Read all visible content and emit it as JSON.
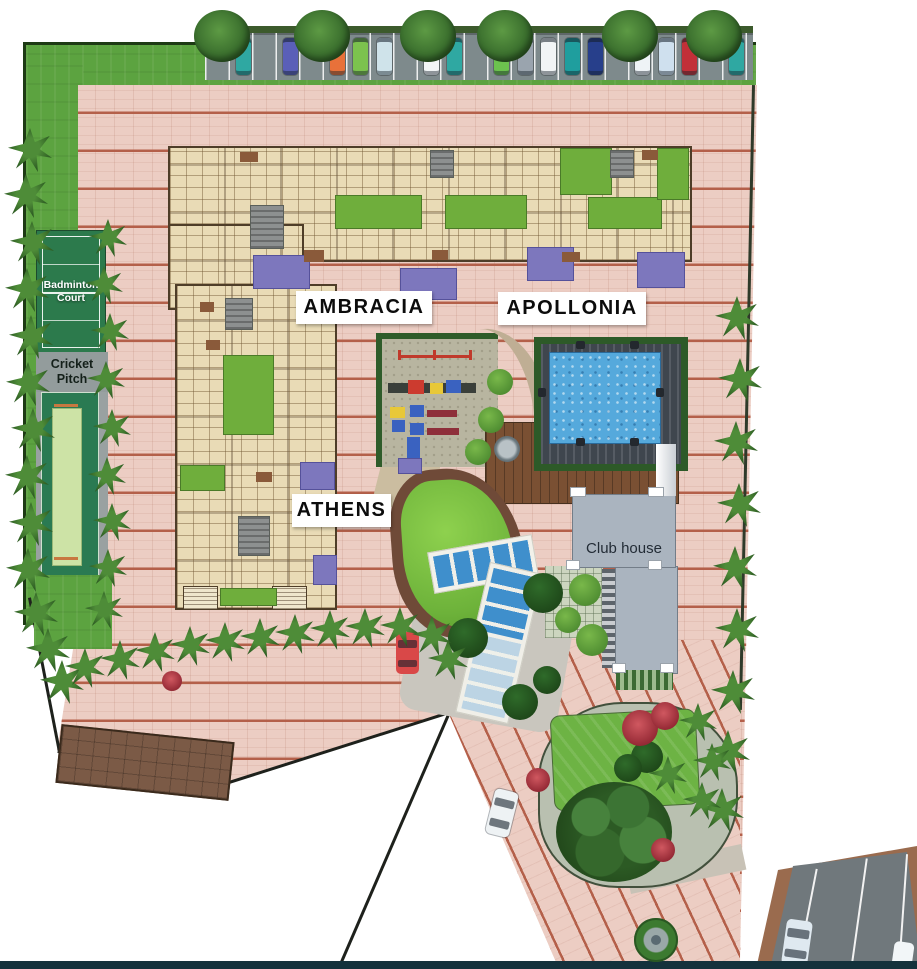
{
  "labels": {
    "ambracia": "AMBRACIA",
    "apollonia": "APOLLONIA",
    "athens": "ATHENS",
    "club_house": "Club house",
    "badminton_court": "Badminton Court",
    "cricket_pitch": "Cricket Pitch"
  },
  "colors": {
    "paving": "#eccdc3",
    "paving_stripe": "#b4604a",
    "lawn": "#5ca340",
    "court_green": "#2c7a4c",
    "pool_water": "#55a9dc",
    "deck": "#7a5033",
    "clubhouse": "#aab4bf",
    "building": "#e9dbb6",
    "courtyard": "#6fae3c",
    "balcony_purple": "#7d77bd",
    "road": "#70787c",
    "island_lawn": "#6db344"
  },
  "plan": {
    "parking_stalls": [
      null,
      "#2fa8a2",
      null,
      "#5a5fb8",
      null,
      "#e8713a",
      "#7cc24e",
      "#cfe3ea",
      null,
      "#f2f5f6",
      "#2fa8a2",
      null,
      "#6cc24e",
      "#9aa4ae",
      "#f2f5f6",
      "#1f9e9e",
      "#273f8b",
      null,
      "#eef3f6",
      "#cfe0ee",
      "#c23038",
      null,
      "#2fa8a2"
    ],
    "canopy_trees_x": [
      222,
      322,
      428,
      505,
      630,
      714
    ],
    "palms": {
      "left": [
        [
          30,
          150
        ],
        [
          26,
          196
        ],
        [
          32,
          243
        ],
        [
          27,
          290
        ],
        [
          31,
          337
        ],
        [
          28,
          384
        ],
        [
          33,
          430
        ],
        [
          27,
          477
        ],
        [
          31,
          524
        ],
        [
          28,
          570
        ],
        [
          36,
          614
        ],
        [
          48,
          650
        ],
        [
          62,
          682
        ]
      ],
      "courts": [
        [
          108,
          238
        ],
        [
          104,
          285
        ],
        [
          110,
          332
        ],
        [
          106,
          380
        ],
        [
          112,
          428
        ],
        [
          107,
          476
        ],
        [
          112,
          522
        ],
        [
          108,
          568
        ],
        [
          104,
          610
        ]
      ],
      "diagonal": [
        [
          85,
          668
        ],
        [
          120,
          660
        ],
        [
          155,
          652
        ],
        [
          190,
          646
        ],
        [
          225,
          642
        ],
        [
          260,
          638
        ],
        [
          295,
          634
        ],
        [
          330,
          630
        ],
        [
          365,
          628
        ],
        [
          400,
          627
        ],
        [
          432,
          636
        ],
        [
          448,
          660
        ]
      ],
      "right": [
        [
          737,
          318
        ],
        [
          740,
          380
        ],
        [
          736,
          443
        ],
        [
          739,
          505
        ],
        [
          735,
          568
        ],
        [
          737,
          630
        ],
        [
          733,
          692
        ],
        [
          728,
          752
        ],
        [
          722,
          810
        ]
      ],
      "island": [
        [
          698,
          722
        ],
        [
          712,
          762
        ],
        [
          702,
          801
        ],
        [
          668,
          775
        ]
      ]
    },
    "path_shrubs": [
      [
        500,
        382
      ],
      [
        491,
        420
      ],
      [
        478,
        452
      ]
    ],
    "courtyards": [
      [
        335,
        195,
        85,
        32
      ],
      [
        445,
        195,
        80,
        32
      ],
      [
        560,
        148,
        50,
        45
      ],
      [
        588,
        197,
        72,
        30
      ],
      [
        657,
        148,
        30,
        50
      ],
      [
        223,
        355,
        49,
        78
      ],
      [
        180,
        465,
        43,
        24
      ],
      [
        220,
        588,
        55,
        16
      ]
    ],
    "purple_patches": [
      [
        253,
        255,
        55,
        32
      ],
      [
        400,
        268,
        55,
        30
      ],
      [
        527,
        247,
        45,
        32
      ],
      [
        637,
        252,
        46,
        34
      ],
      [
        300,
        462,
        33,
        26
      ],
      [
        398,
        458,
        22,
        14
      ],
      [
        313,
        555,
        22,
        28
      ]
    ],
    "cores": [
      [
        250,
        205,
        32,
        42
      ],
      [
        225,
        298,
        26,
        30
      ],
      [
        238,
        516,
        30,
        38
      ],
      [
        430,
        150,
        22,
        26
      ],
      [
        610,
        150,
        22,
        26
      ]
    ],
    "accents": [
      [
        240,
        152,
        18,
        10
      ],
      [
        304,
        250,
        20,
        12
      ],
      [
        432,
        250,
        16,
        10
      ],
      [
        562,
        252,
        18,
        10
      ],
      [
        642,
        150,
        16,
        10
      ],
      [
        200,
        302,
        14,
        10
      ],
      [
        256,
        472,
        16,
        10
      ],
      [
        206,
        340,
        14,
        10
      ]
    ],
    "playground_items": [
      {
        "x": 398,
        "y": 355,
        "w": 74,
        "h": 3,
        "c": "#c0392b"
      },
      {
        "x": 398,
        "y": 350,
        "w": 3,
        "h": 10,
        "c": "#c0392b"
      },
      {
        "x": 433,
        "y": 350,
        "w": 3,
        "h": 10,
        "c": "#c0392b"
      },
      {
        "x": 469,
        "y": 350,
        "w": 3,
        "h": 10,
        "c": "#c0392b"
      },
      {
        "x": 388,
        "y": 383,
        "w": 88,
        "h": 10,
        "c": "#3a3f3a"
      },
      {
        "x": 408,
        "y": 380,
        "w": 16,
        "h": 14,
        "c": "#cc3b2f"
      },
      {
        "x": 430,
        "y": 383,
        "w": 13,
        "h": 11,
        "c": "#e8c838"
      },
      {
        "x": 446,
        "y": 380,
        "w": 15,
        "h": 13,
        "c": "#3a62c0"
      },
      {
        "x": 390,
        "y": 407,
        "w": 15,
        "h": 11,
        "c": "#e8c838"
      },
      {
        "x": 410,
        "y": 405,
        "w": 14,
        "h": 12,
        "c": "#3a62c0"
      },
      {
        "x": 427,
        "y": 410,
        "w": 30,
        "h": 7,
        "c": "#8e2f3a"
      },
      {
        "x": 392,
        "y": 420,
        "w": 13,
        "h": 12,
        "c": "#3a62c0"
      },
      {
        "x": 410,
        "y": 423,
        "w": 14,
        "h": 12,
        "c": "#3a62c0"
      },
      {
        "x": 427,
        "y": 428,
        "w": 32,
        "h": 7,
        "c": "#8e2f3a"
      },
      {
        "x": 407,
        "y": 437,
        "w": 13,
        "h": 24,
        "c": "#3a62c0"
      }
    ],
    "pool_ladders": [
      [
        576,
        341,
        9,
        8
      ],
      [
        630,
        341,
        9,
        8
      ],
      [
        576,
        438,
        9,
        8
      ],
      [
        630,
        438,
        9,
        8
      ],
      [
        538,
        388,
        8,
        9
      ],
      [
        656,
        388,
        8,
        9
      ]
    ],
    "bushes_dark": [
      [
        543,
        593,
        20
      ],
      [
        468,
        638,
        20
      ],
      [
        520,
        702,
        18
      ],
      [
        547,
        680,
        14
      ],
      [
        647,
        757,
        16
      ],
      [
        628,
        768,
        14
      ]
    ],
    "bushes_light": [
      [
        585,
        590,
        16
      ],
      [
        592,
        640,
        16
      ],
      [
        568,
        620,
        13
      ]
    ],
    "flowers": [
      [
        640,
        728,
        18
      ],
      [
        665,
        716,
        14
      ],
      [
        663,
        850,
        12
      ],
      [
        538,
        780,
        12
      ],
      [
        172,
        681,
        10
      ]
    ],
    "canopy_squares": [
      [
        570,
        487,
        14,
        8
      ],
      [
        648,
        487,
        14,
        8
      ],
      [
        566,
        560,
        12,
        8
      ],
      [
        648,
        560,
        12,
        8
      ],
      [
        612,
        663,
        12,
        8
      ],
      [
        660,
        663,
        12,
        8
      ]
    ]
  }
}
